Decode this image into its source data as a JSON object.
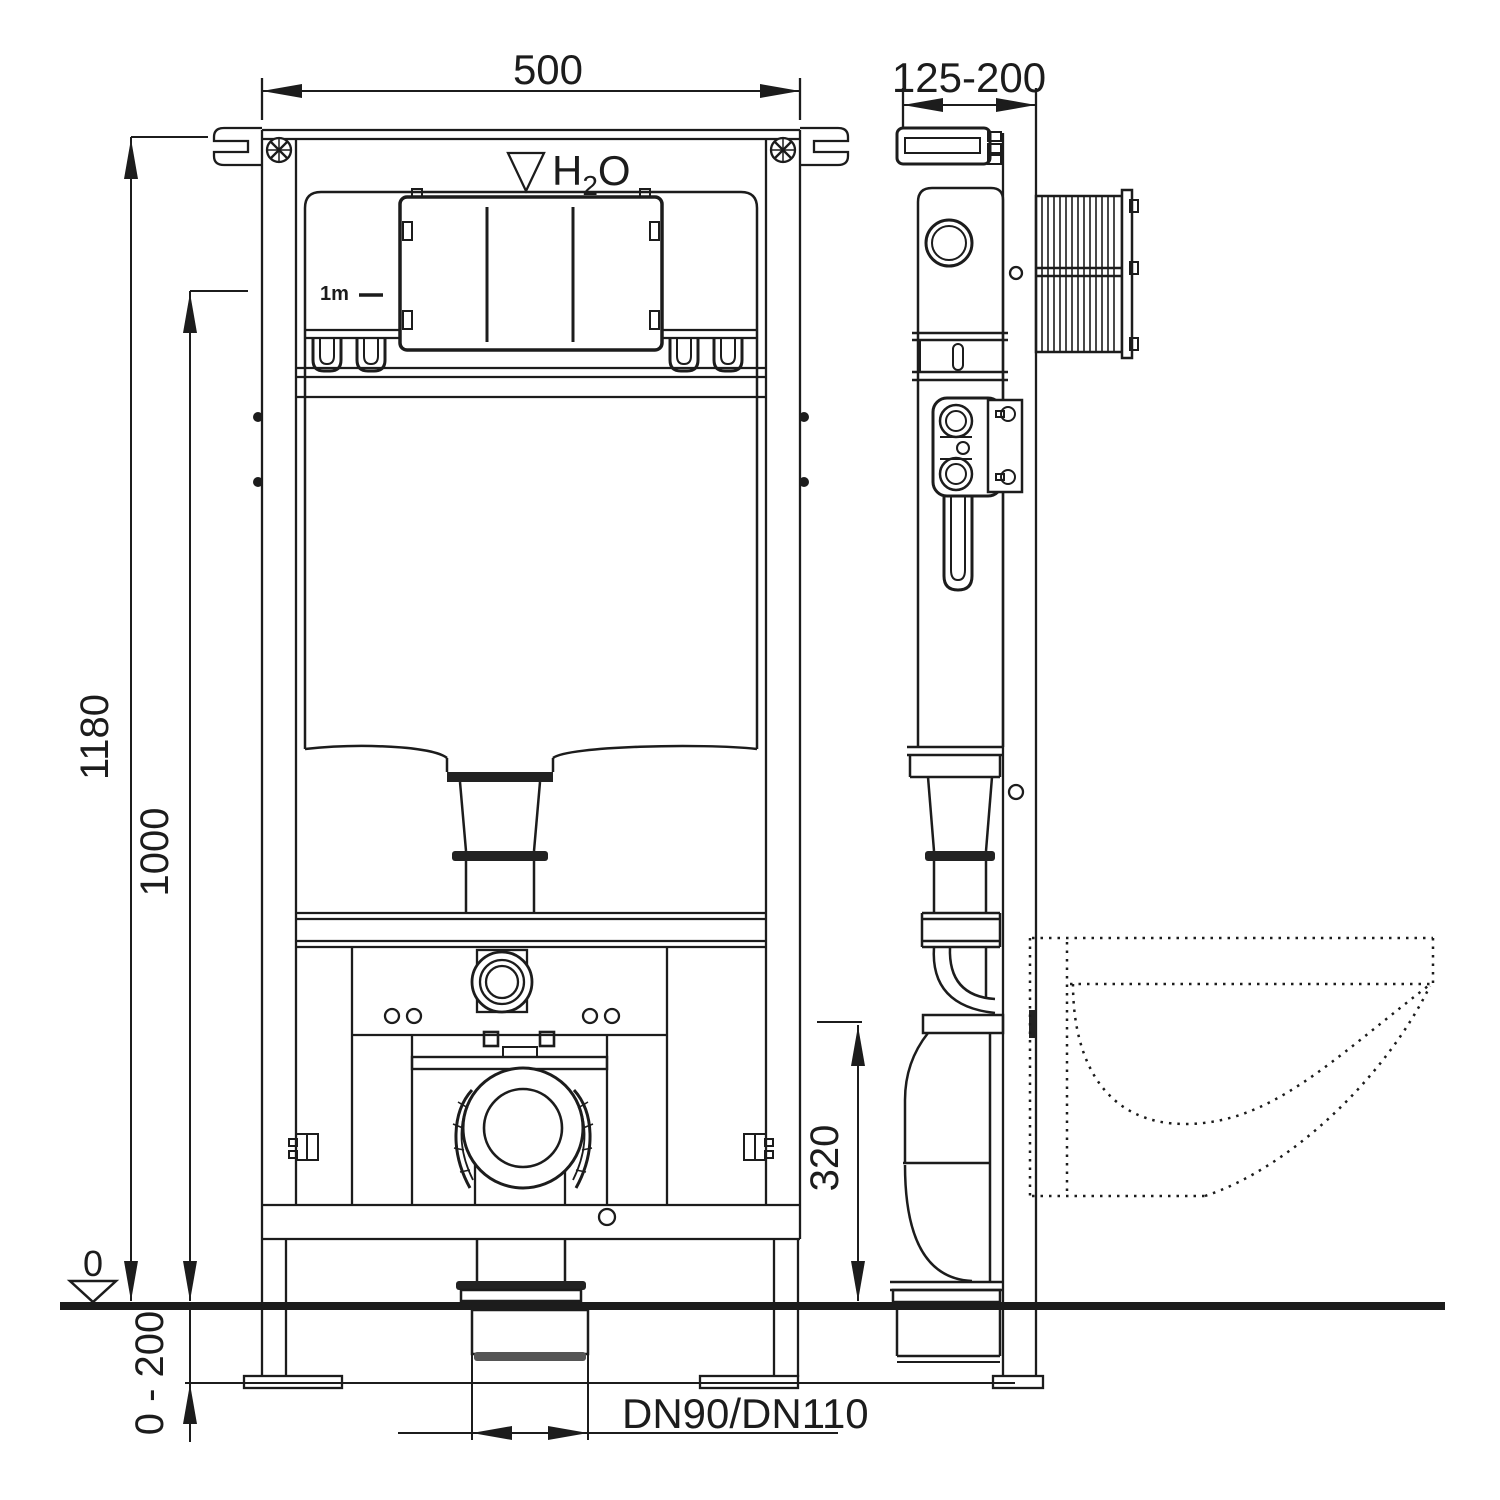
{
  "drawing": {
    "type": "installation-frame-technical-drawing",
    "views": [
      "front-view",
      "side-view"
    ],
    "colors": {
      "ink": "#1c1c1c",
      "background": "#ffffff",
      "fill_dark": "#222222"
    }
  },
  "labels": {
    "front_width": "500",
    "side_depth": "125-200",
    "total_height": "1180",
    "upper_height": "1000",
    "outlet_height": "320",
    "below_floor_range": "0 - 200",
    "floor_level": "0",
    "drain_diameter": "DN90/DN110",
    "water_h": "H",
    "water_sub": "2",
    "water_o": "O",
    "scale_note": "1m"
  }
}
